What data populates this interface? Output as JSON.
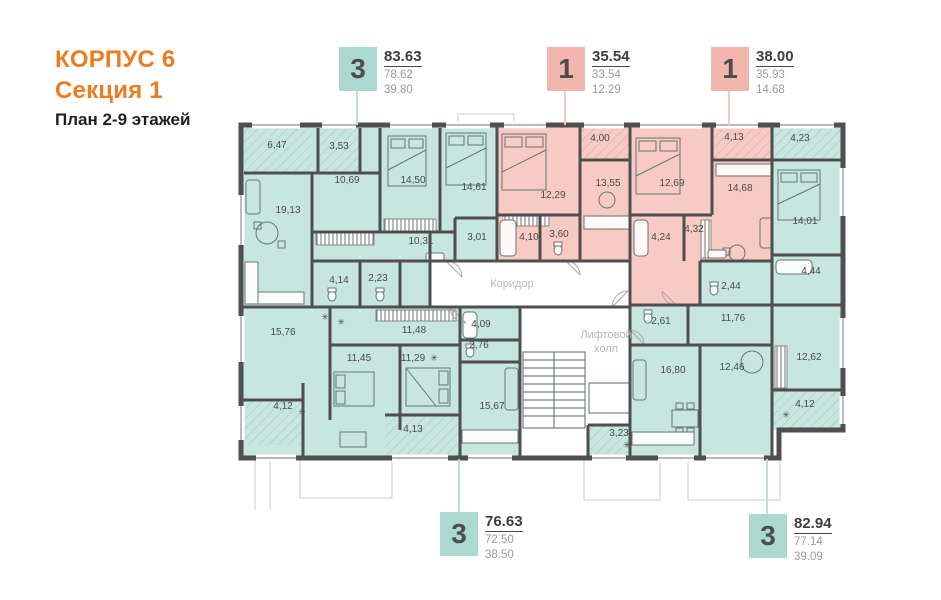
{
  "title": {
    "building": "КОРПУС 6",
    "section": "Секция 1",
    "plan": "План 2-9 этажей"
  },
  "colors": {
    "accent_orange": "#ee7c1e",
    "teal_room": "#c6e6df",
    "teal_badge": "#abd9d0",
    "pink_room": "#f7cac3",
    "pink_badge": "#f3b6af",
    "wall": "#4f4f4f"
  },
  "callouts": [
    {
      "rooms": "3",
      "color": "teal",
      "total_area": "83.63",
      "area": "78.62",
      "living_area": "39.80"
    },
    {
      "rooms": "1",
      "color": "pink",
      "total_area": "35.54",
      "area": "33.54",
      "living_area": "12.29"
    },
    {
      "rooms": "1",
      "color": "pink",
      "total_area": "38.00",
      "area": "35.93",
      "living_area": "14.68"
    },
    {
      "rooms": "3",
      "color": "teal",
      "total_area": "76.63",
      "area": "72.50",
      "living_area": "38.50"
    },
    {
      "rooms": "3",
      "color": "teal",
      "total_area": "82.94",
      "area": "77.14",
      "living_area": "39.09"
    }
  ],
  "plan": {
    "corridor_label": "Коридор",
    "elevator_hall_label": [
      "Лифтовой",
      "холл"
    ],
    "rooms": [
      {
        "label": "6,47",
        "x": 277,
        "y": 148
      },
      {
        "label": "3,53",
        "x": 339,
        "y": 149
      },
      {
        "label": "10,69",
        "x": 347,
        "y": 183
      },
      {
        "label": "14,50",
        "x": 413,
        "y": 183
      },
      {
        "label": "14,61",
        "x": 474,
        "y": 190
      },
      {
        "label": "19,13",
        "x": 288,
        "y": 213
      },
      {
        "label": "10,31",
        "x": 421,
        "y": 244
      },
      {
        "label": "4,14",
        "x": 339,
        "y": 283
      },
      {
        "label": "2,23",
        "x": 378,
        "y": 281
      },
      {
        "label": "3,01",
        "x": 477,
        "y": 240
      },
      {
        "label": "12,29",
        "x": 553,
        "y": 198
      },
      {
        "label": "4,00",
        "x": 600,
        "y": 141
      },
      {
        "label": "13,55",
        "x": 608,
        "y": 186
      },
      {
        "label": "4,10",
        "x": 529,
        "y": 240
      },
      {
        "label": "3,60",
        "x": 559,
        "y": 237
      },
      {
        "label": "12,69",
        "x": 672,
        "y": 186
      },
      {
        "label": "4,13",
        "x": 734,
        "y": 140
      },
      {
        "label": "14,68",
        "x": 740,
        "y": 191
      },
      {
        "label": "4,24",
        "x": 661,
        "y": 240
      },
      {
        "label": "4,32",
        "x": 694,
        "y": 232
      },
      {
        "label": "4,23",
        "x": 800,
        "y": 141
      },
      {
        "label": "14,01",
        "x": 805,
        "y": 224
      },
      {
        "label": "4,44",
        "x": 811,
        "y": 274
      },
      {
        "label": "2,44",
        "x": 731,
        "y": 289
      },
      {
        "label": "2,61",
        "x": 661,
        "y": 324
      },
      {
        "label": "11,76",
        "x": 733,
        "y": 321
      },
      {
        "label": "16,80",
        "x": 673,
        "y": 373
      },
      {
        "label": "12,46",
        "x": 732,
        "y": 370
      },
      {
        "label": "12,62",
        "x": 809,
        "y": 360
      },
      {
        "label": "4,12",
        "x": 805,
        "y": 407
      },
      {
        "label": "3,23",
        "x": 619,
        "y": 436
      },
      {
        "label": "15,76",
        "x": 283,
        "y": 335
      },
      {
        "label": "11,48",
        "x": 414,
        "y": 333
      },
      {
        "label": "11,45",
        "x": 359,
        "y": 361
      },
      {
        "label": "11,29",
        "x": 413,
        "y": 361
      },
      {
        "label": "4,12",
        "x": 283,
        "y": 409
      },
      {
        "label": "4,13",
        "x": 413,
        "y": 432
      },
      {
        "label": "4,09",
        "x": 481,
        "y": 327
      },
      {
        "label": "2,76",
        "x": 479,
        "y": 348
      },
      {
        "label": "15,67",
        "x": 492,
        "y": 409
      }
    ]
  }
}
